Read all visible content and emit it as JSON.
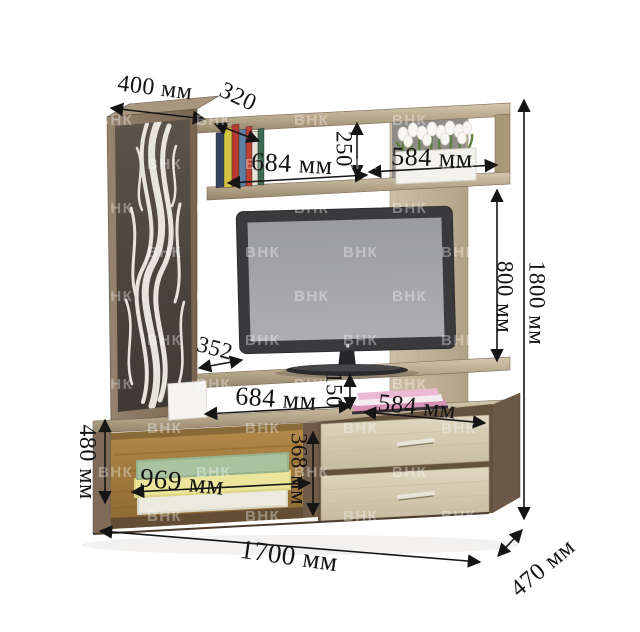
{
  "watermark": {
    "text": "ВНК"
  },
  "dimensions": {
    "cabinet_top_width": "400 мм",
    "cabinet_top_depth": "320",
    "upper_shelf_width": "684 мм",
    "upper_shelf_height": "250",
    "upper_right_shelf_width": "584 мм",
    "right_opening_height": "800 мм",
    "total_height": "1800 мм",
    "tv_shelf_depth": "352",
    "tv_niche_width": "684 мм",
    "tv_niche_height": "150",
    "lower_right_shelf_width": "584 мм",
    "drawer_section_height": "368 мм",
    "base_niche_width": "969 мм",
    "base_height": "480 мм",
    "total_width": "1700 мм",
    "total_depth": "470 мм"
  },
  "palette": {
    "dimension_text": "#151515",
    "wood_dark": "#7a6856",
    "wood_light": "#cfc4aa",
    "drawer_front": "#d8cfb8",
    "niche_back_panel": "#a87f3e",
    "tv_screen": "#a5a5a9"
  }
}
